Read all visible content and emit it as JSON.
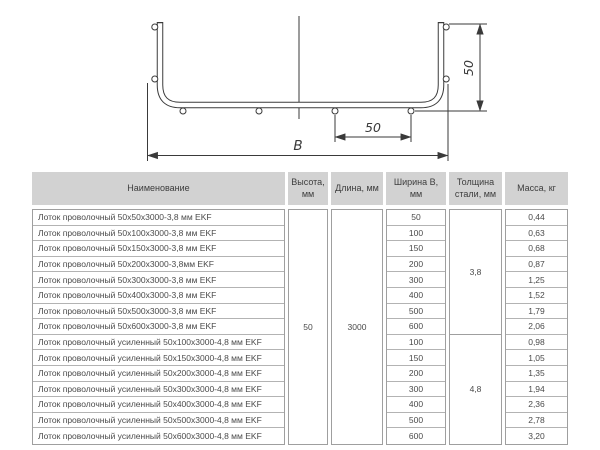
{
  "drawing": {
    "side_height_label": "50",
    "wire_pitch_label": "50",
    "width_label": "B"
  },
  "table": {
    "headers": [
      "Наименование",
      "Высота, мм",
      "Длина, мм",
      "Ширина B, мм",
      "Толщина стали, мм",
      "Масса, кг"
    ],
    "height_mm": "50",
    "length_mm": "3000",
    "groups": [
      {
        "thickness_mm": "3,8",
        "rows": [
          {
            "name": "Лоток проволочный 50x50x3000-3,8 мм EKF",
            "width_mm": "50",
            "mass_kg": "0,44"
          },
          {
            "name": "Лоток проволочный 50x100x3000-3,8 мм EKF",
            "width_mm": "100",
            "mass_kg": "0,63"
          },
          {
            "name": "Лоток проволочный 50x150x3000-3,8 мм EKF",
            "width_mm": "150",
            "mass_kg": "0,68"
          },
          {
            "name": "Лоток проволочный 50x200x3000-3,8мм EKF",
            "width_mm": "200",
            "mass_kg": "0,87"
          },
          {
            "name": "Лоток проволочный 50x300x3000-3,8 мм EKF",
            "width_mm": "300",
            "mass_kg": "1,25"
          },
          {
            "name": "Лоток проволочный 50x400x3000-3,8 мм EKF",
            "width_mm": "400",
            "mass_kg": "1,52"
          },
          {
            "name": "Лоток проволочный 50x500x3000-3,8 мм EKF",
            "width_mm": "500",
            "mass_kg": "1,79"
          },
          {
            "name": "Лоток проволочный 50x600x3000-3,8 мм EKF",
            "width_mm": "600",
            "mass_kg": "2,06"
          }
        ]
      },
      {
        "thickness_mm": "4,8",
        "rows": [
          {
            "name": "Лоток проволочный усиленный 50x100x3000-4,8 мм EKF",
            "width_mm": "100",
            "mass_kg": "0,98"
          },
          {
            "name": "Лоток проволочный усиленный 50x150x3000-4,8 мм EKF",
            "width_mm": "150",
            "mass_kg": "1,05"
          },
          {
            "name": "Лоток проволочный усиленный 50x200x3000-4,8 мм EKF",
            "width_mm": "200",
            "mass_kg": "1,35"
          },
          {
            "name": "Лоток проволочный усиленный 50x300x3000-4,8 мм EKF",
            "width_mm": "300",
            "mass_kg": "1,94"
          },
          {
            "name": "Лоток проволочный усиленный 50x400x3000-4,8 мм EKF",
            "width_mm": "400",
            "mass_kg": "2,36"
          },
          {
            "name": "Лоток проволочный усиленный 50x500x3000-4,8 мм EKF",
            "width_mm": "500",
            "mass_kg": "2,78"
          },
          {
            "name": "Лоток проволочный усиленный 50x600x3000-4,8 мм EKF",
            "width_mm": "600",
            "mass_kg": "3,20"
          }
        ]
      }
    ]
  }
}
